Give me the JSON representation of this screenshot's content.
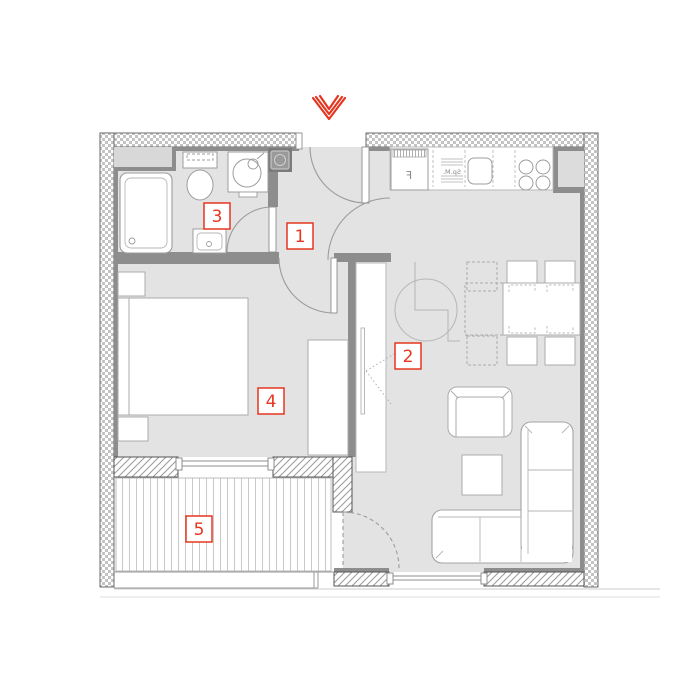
{
  "plan": {
    "type": "apartment-floor-plan",
    "entrance": {
      "marker": "chevron-down",
      "color": "#e5361f"
    },
    "rooms": [
      {
        "number": "1",
        "name": "hall"
      },
      {
        "number": "2",
        "name": "living-room-kitchen"
      },
      {
        "number": "3",
        "name": "bathroom"
      },
      {
        "number": "4",
        "name": "bedroom"
      },
      {
        "number": "5",
        "name": "balcony"
      }
    ],
    "kitchen_labels": {
      "fridge": "F",
      "dishwasher": "Sp.M."
    },
    "colors": {
      "accent_red": "#e5361f",
      "floor_gray": "#e3e3e3",
      "inner_wall_gray": "#8d8d8d",
      "fixture_stroke": "#9c9c9c",
      "hatch_line": "#9a9a9a"
    }
  }
}
